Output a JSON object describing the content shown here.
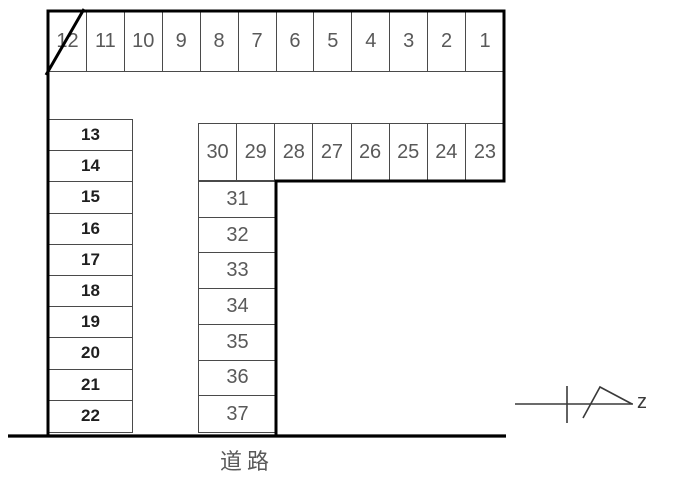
{
  "diagram_title": "parking-lot-layout",
  "lot": {
    "top_row": {
      "cells": [
        "12",
        "11",
        "10",
        "9",
        "8",
        "7",
        "6",
        "5",
        "4",
        "3",
        "2",
        "1"
      ],
      "crossed_out_space": "12"
    },
    "left_column": {
      "cells": [
        "13",
        "14",
        "15",
        "16",
        "17",
        "18",
        "19",
        "20",
        "21",
        "22"
      ]
    },
    "middle_row": {
      "cells": [
        "30",
        "29",
        "28",
        "27",
        "26",
        "25",
        "24",
        "23"
      ]
    },
    "lower_column": {
      "cells": [
        "31",
        "32",
        "33",
        "34",
        "35",
        "36",
        "37"
      ]
    }
  },
  "road_label": "道路",
  "north_arrow": {
    "label": "z"
  },
  "colors": {
    "background": "#ffffff",
    "thick_line": "#000000",
    "thin_line": "#4a4a4a",
    "number_text": "#595959",
    "bold_number_text": "#1f1f1f"
  }
}
